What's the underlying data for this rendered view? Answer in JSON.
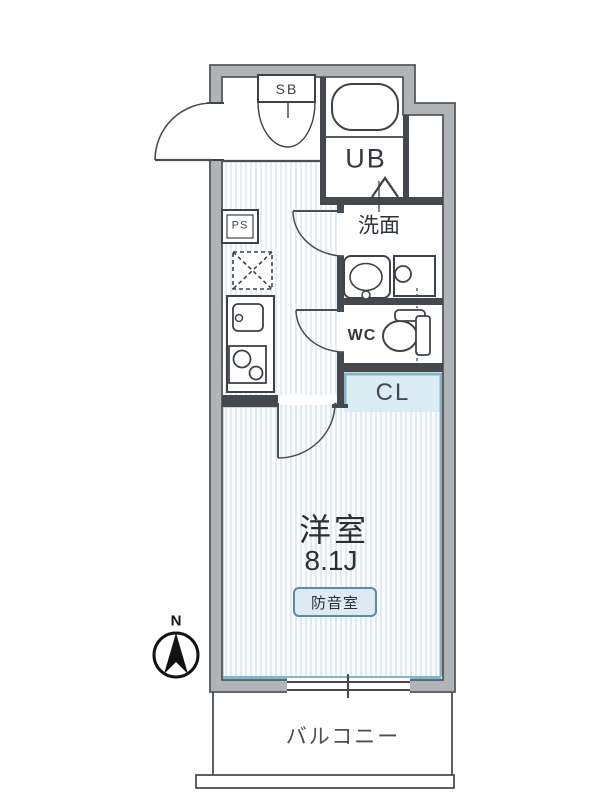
{
  "title": "floor-plan",
  "labels": {
    "shoe_box": "SB",
    "unit_bath": "UB",
    "washroom": "洗面",
    "toilet": "WC",
    "closet": "CL",
    "pipe_space": "PS",
    "main_room_name": "洋室",
    "main_room_size": "8.1J",
    "soundproof_badge": "防音室",
    "balcony": "バルコニー",
    "compass_north": "N"
  },
  "rooms": {
    "main_room": {
      "name": "洋室",
      "size_tatami": "8.1J",
      "note": "防音室"
    },
    "balcony": {
      "name": "バルコニー"
    },
    "unit_bath": {
      "name": "UB"
    },
    "washroom": {
      "name": "洗面"
    },
    "toilet": {
      "name": "WC"
    },
    "closet": {
      "name": "CL"
    },
    "shoe_box": {
      "name": "SB"
    },
    "pipe_space": {
      "name": "PS"
    }
  },
  "colors": {
    "wall_fill": "#b0b4b7",
    "wall_outline": "#54585c",
    "inner_wall": "#45494d",
    "line_dark": "#3e4246",
    "floor_stripe": "#e3edf2",
    "room_tint": "#f8fcfe",
    "closet_fill": "#dcecf5",
    "accent_teal": "#8ab4c6",
    "badge_fill": "#ddeaf4",
    "badge_border": "#5e8aa2",
    "text": "#2e3338"
  }
}
